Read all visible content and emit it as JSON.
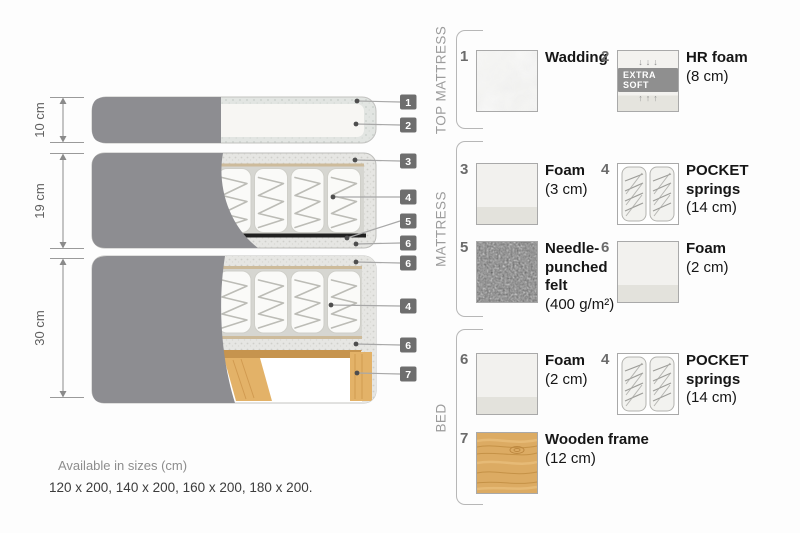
{
  "page": {
    "background": "#fdfdfd"
  },
  "diagram": {
    "measurements": [
      "10 cm",
      "19 cm",
      "30 cm"
    ],
    "tags": [
      "1",
      "2",
      "3",
      "4",
      "5",
      "6",
      "6",
      "4",
      "6",
      "7"
    ],
    "sizes_label": "Available in sizes (cm)",
    "sizes_values": "120 x 200, 140 x 200, 160 x 200, 180 x 200."
  },
  "groups": [
    {
      "label": "TOP MATTRESS"
    },
    {
      "label": "MATTRESS"
    },
    {
      "label": "BED"
    }
  ],
  "legend": {
    "items": [
      {
        "number": "1",
        "name": "Wadding",
        "detail": ""
      },
      {
        "number": "2",
        "name": "HR foam",
        "detail": "(8 cm)",
        "badge": "EXTRA SOFT",
        "arrows_down": "↓↓↓",
        "arrows_up": "↑↑↑"
      },
      {
        "number": "3",
        "name": "Foam",
        "detail": "(3 cm)"
      },
      {
        "number": "4",
        "name": "POCKET springs",
        "detail": "(14 cm)"
      },
      {
        "number": "5",
        "name": "Needle-punched felt",
        "detail": "(400 g/m²)"
      },
      {
        "number": "6",
        "name": "Foam",
        "detail": "(2 cm)"
      },
      {
        "number": "6",
        "name": "Foam",
        "detail": "(2 cm)"
      },
      {
        "number": "4",
        "name": "POCKET springs",
        "detail": "(14 cm)"
      },
      {
        "number": "7",
        "name": "Wooden frame",
        "detail": "(12 cm)"
      }
    ]
  },
  "colors": {
    "cover_fabric": "#8d8d91",
    "foam_texture": "#e6e6e3",
    "wadding_texture": "#e2e5e2",
    "wood": "#dcab63",
    "felt": "#767676",
    "tag_background": "#6e6e6e",
    "badge_background": "#8f8f8f",
    "text_dark": "#161616",
    "text_gray": "#9c9c9c"
  }
}
